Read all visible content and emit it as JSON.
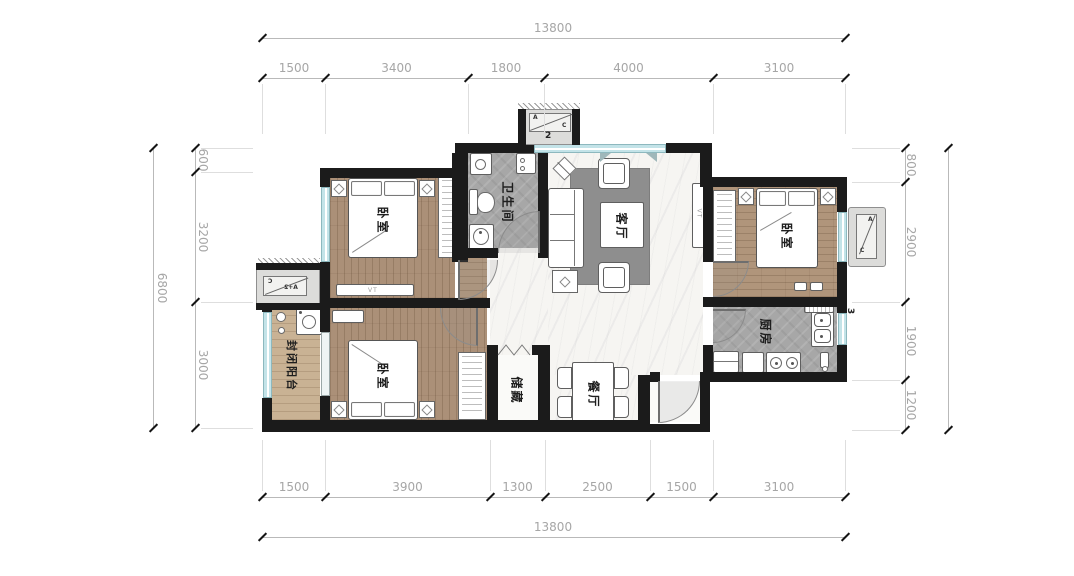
{
  "plan": {
    "rooms": {
      "bedroom_main": "卧室",
      "bedroom_right": "卧室",
      "bedroom_lower": "卧室",
      "bathroom": "卫生间",
      "living": "客厅",
      "dining": "餐厅",
      "kitchen": "厨房",
      "storage": "储藏",
      "balcony": "封闭阳台"
    },
    "annotations": {
      "tv_label_living": "VT",
      "tv_label_bedroom": "VT",
      "ac_platform_top_number": "2",
      "ac_platform_right_number": "3",
      "ac_letter_a": "A",
      "ac_letter_c": "C",
      "ac_left_text": "A+2"
    }
  },
  "dimensions": {
    "top": {
      "total": "13800",
      "segments": [
        "1500",
        "3400",
        "1800",
        "4000",
        "3100"
      ]
    },
    "bottom": {
      "total": "13800",
      "segments": [
        "1500",
        "3900",
        "1300",
        "2500",
        "1500",
        "3100"
      ]
    },
    "left": {
      "total": "6800",
      "segments": [
        "600",
        "3200",
        "3000"
      ]
    },
    "right": {
      "segments": [
        "800",
        "2900",
        "1900",
        "1200"
      ]
    }
  }
}
